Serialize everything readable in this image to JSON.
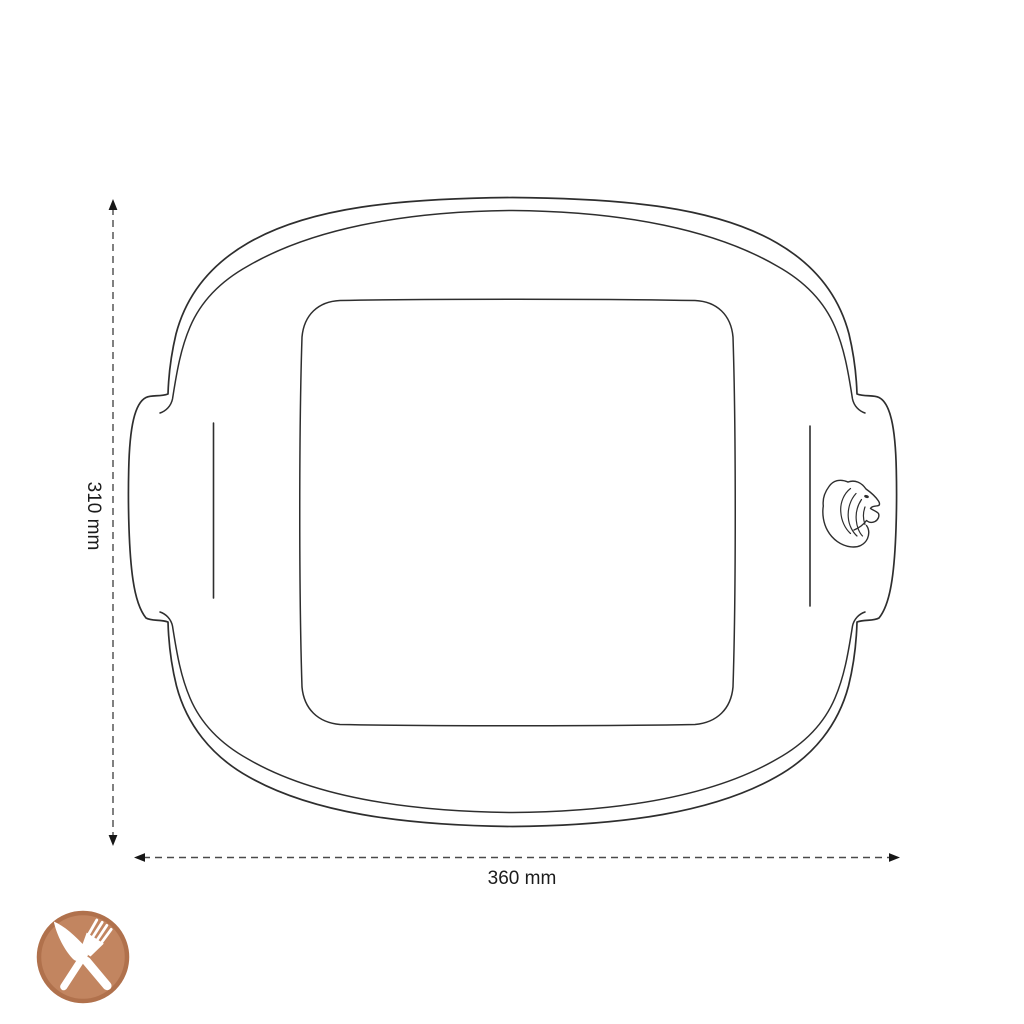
{
  "diagram": {
    "dimensions": {
      "height_label": "310 mm",
      "width_label": "360 mm"
    },
    "icons": {
      "logo": "lion-head-engraving",
      "badge": "crossed-knife-and-fork"
    },
    "colors": {
      "line": "#2e2e2e",
      "dimension_line": "#4a4a4a",
      "arrowhead": "#171717",
      "text": "#1b1b1b",
      "badge_fill": "#c28560",
      "badge_ring": "#b0714c",
      "badge_glyph": "#ffffff"
    }
  }
}
